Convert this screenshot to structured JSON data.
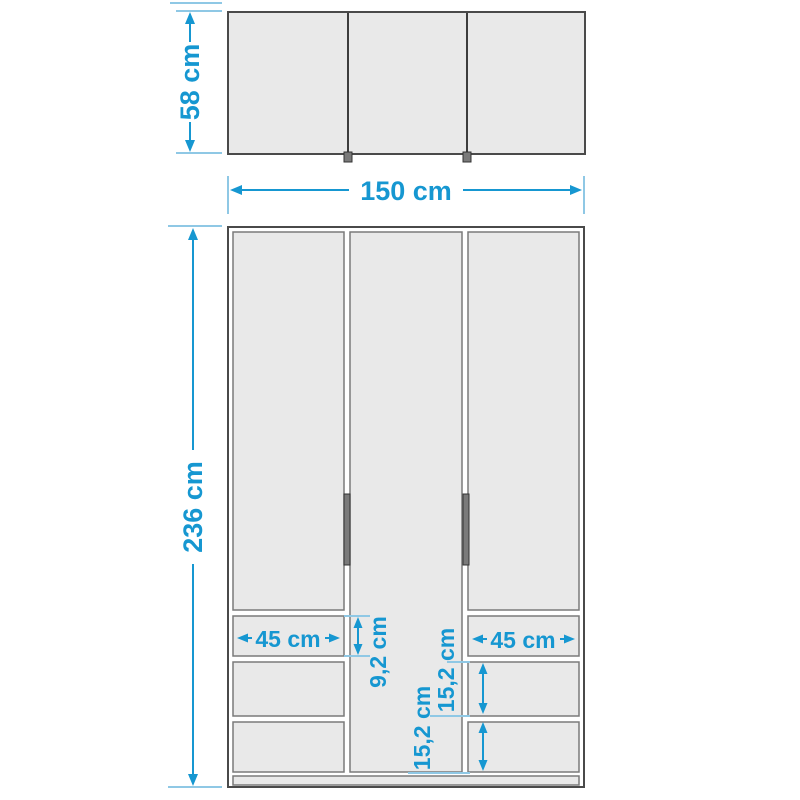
{
  "diagram_type": "furniture-dimension-drawing",
  "subject": "three-door wardrobe with six drawers, top view and front view",
  "colors": {
    "dimension": "#1697d1",
    "extension": "#8fc8e5",
    "panel": "#e9e9e9",
    "panel_border": "#7a7a7a",
    "outline": "#4a4a4a",
    "handle": "#7a7a7a",
    "handle_border": "#333333",
    "background": "#ffffff"
  },
  "structure": {
    "doors": 3,
    "handles": 2,
    "drawers_left": 3,
    "drawers_right": 3
  },
  "labels": {
    "depth": "58 cm",
    "width": "150 cm",
    "height": "236 cm",
    "left_drawer_width": "45 cm",
    "right_drawer_width": "45 cm",
    "top_drawer_height": "9,2 cm",
    "middle_drawer_height": "15,2 cm",
    "bottom_drawer_height": "15,2 cm"
  }
}
